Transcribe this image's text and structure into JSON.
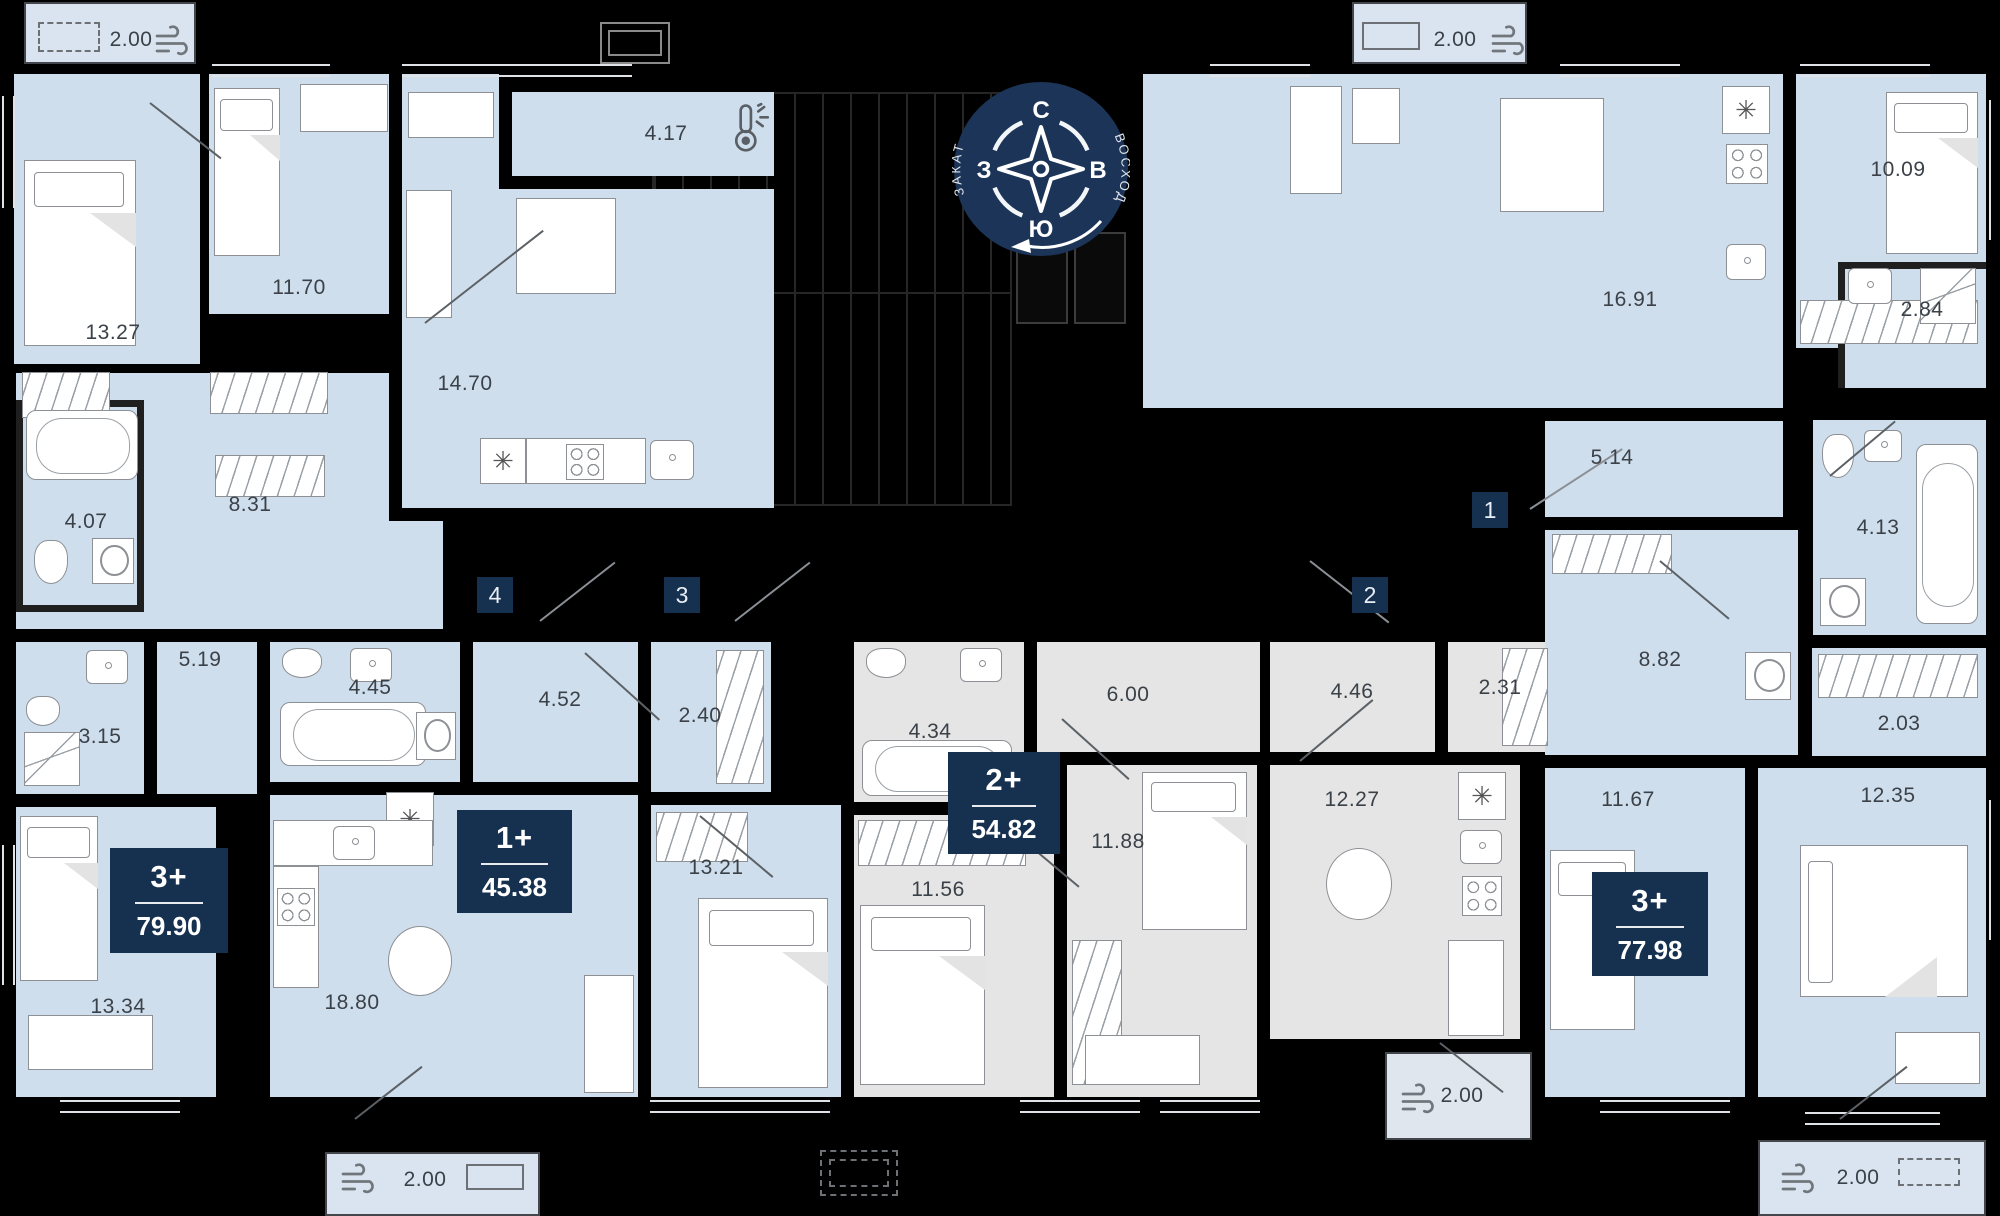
{
  "title": "Поэтажный план — 4 квартиры",
  "compass": {
    "north": "С",
    "east": "В",
    "south": "Ю",
    "west": "З",
    "sunset": "ЗАКАТ",
    "sunrise": "ВОСХОД"
  },
  "apartments": [
    {
      "unit": "1",
      "type": "3+",
      "area": "77.98",
      "rooms": {
        "kitchen_living": "16.91",
        "bedroom_1": "10.09",
        "shower": "2.84",
        "hallway": "5.14",
        "bathroom": "4.13",
        "corridor": "8.82",
        "wardrobe": "2.03",
        "bedroom_2": "11.67",
        "bedroom_3": "12.35"
      },
      "balcony_top": "2.00",
      "balcony_bottom": "2.00"
    },
    {
      "unit": "2",
      "type": "2+",
      "area": "54.82",
      "rooms": {
        "bathroom": "4.34",
        "hallway": "6.00",
        "corridor": "4.46",
        "wardrobe": "2.31",
        "bedroom_1": "11.56",
        "bedroom_2": "11.88",
        "kitchen_living": "12.27"
      },
      "balcony": "2.00"
    },
    {
      "unit": "3",
      "type": "1+",
      "area": "45.38",
      "rooms": {
        "bathroom": "4.45",
        "hallway": "4.52",
        "wardrobe": "2.40",
        "bedroom": "13.21",
        "kitchen_living": "18.80"
      },
      "balcony": "2.00"
    },
    {
      "unit": "4",
      "type": "3+",
      "area": "79.90",
      "rooms": {
        "bedroom_1": "13.27",
        "bedroom_2": "11.70",
        "loggia": "4.17",
        "kitchen_living": "14.70",
        "hallway": "8.31",
        "bathroom": "4.07",
        "corridor": "5.19",
        "shower": "3.15",
        "bedroom_3": "13.34"
      },
      "balcony": "2.00"
    }
  ],
  "icons": {
    "wind": "wind-icon",
    "thermometer": "thermometer-icon"
  },
  "colors": {
    "room_blue": "#cfdeed",
    "room_gray": "#e4e5e4",
    "wall": "#000000",
    "badge_navy": "#16304f",
    "compass_navy": "#1c3457"
  }
}
